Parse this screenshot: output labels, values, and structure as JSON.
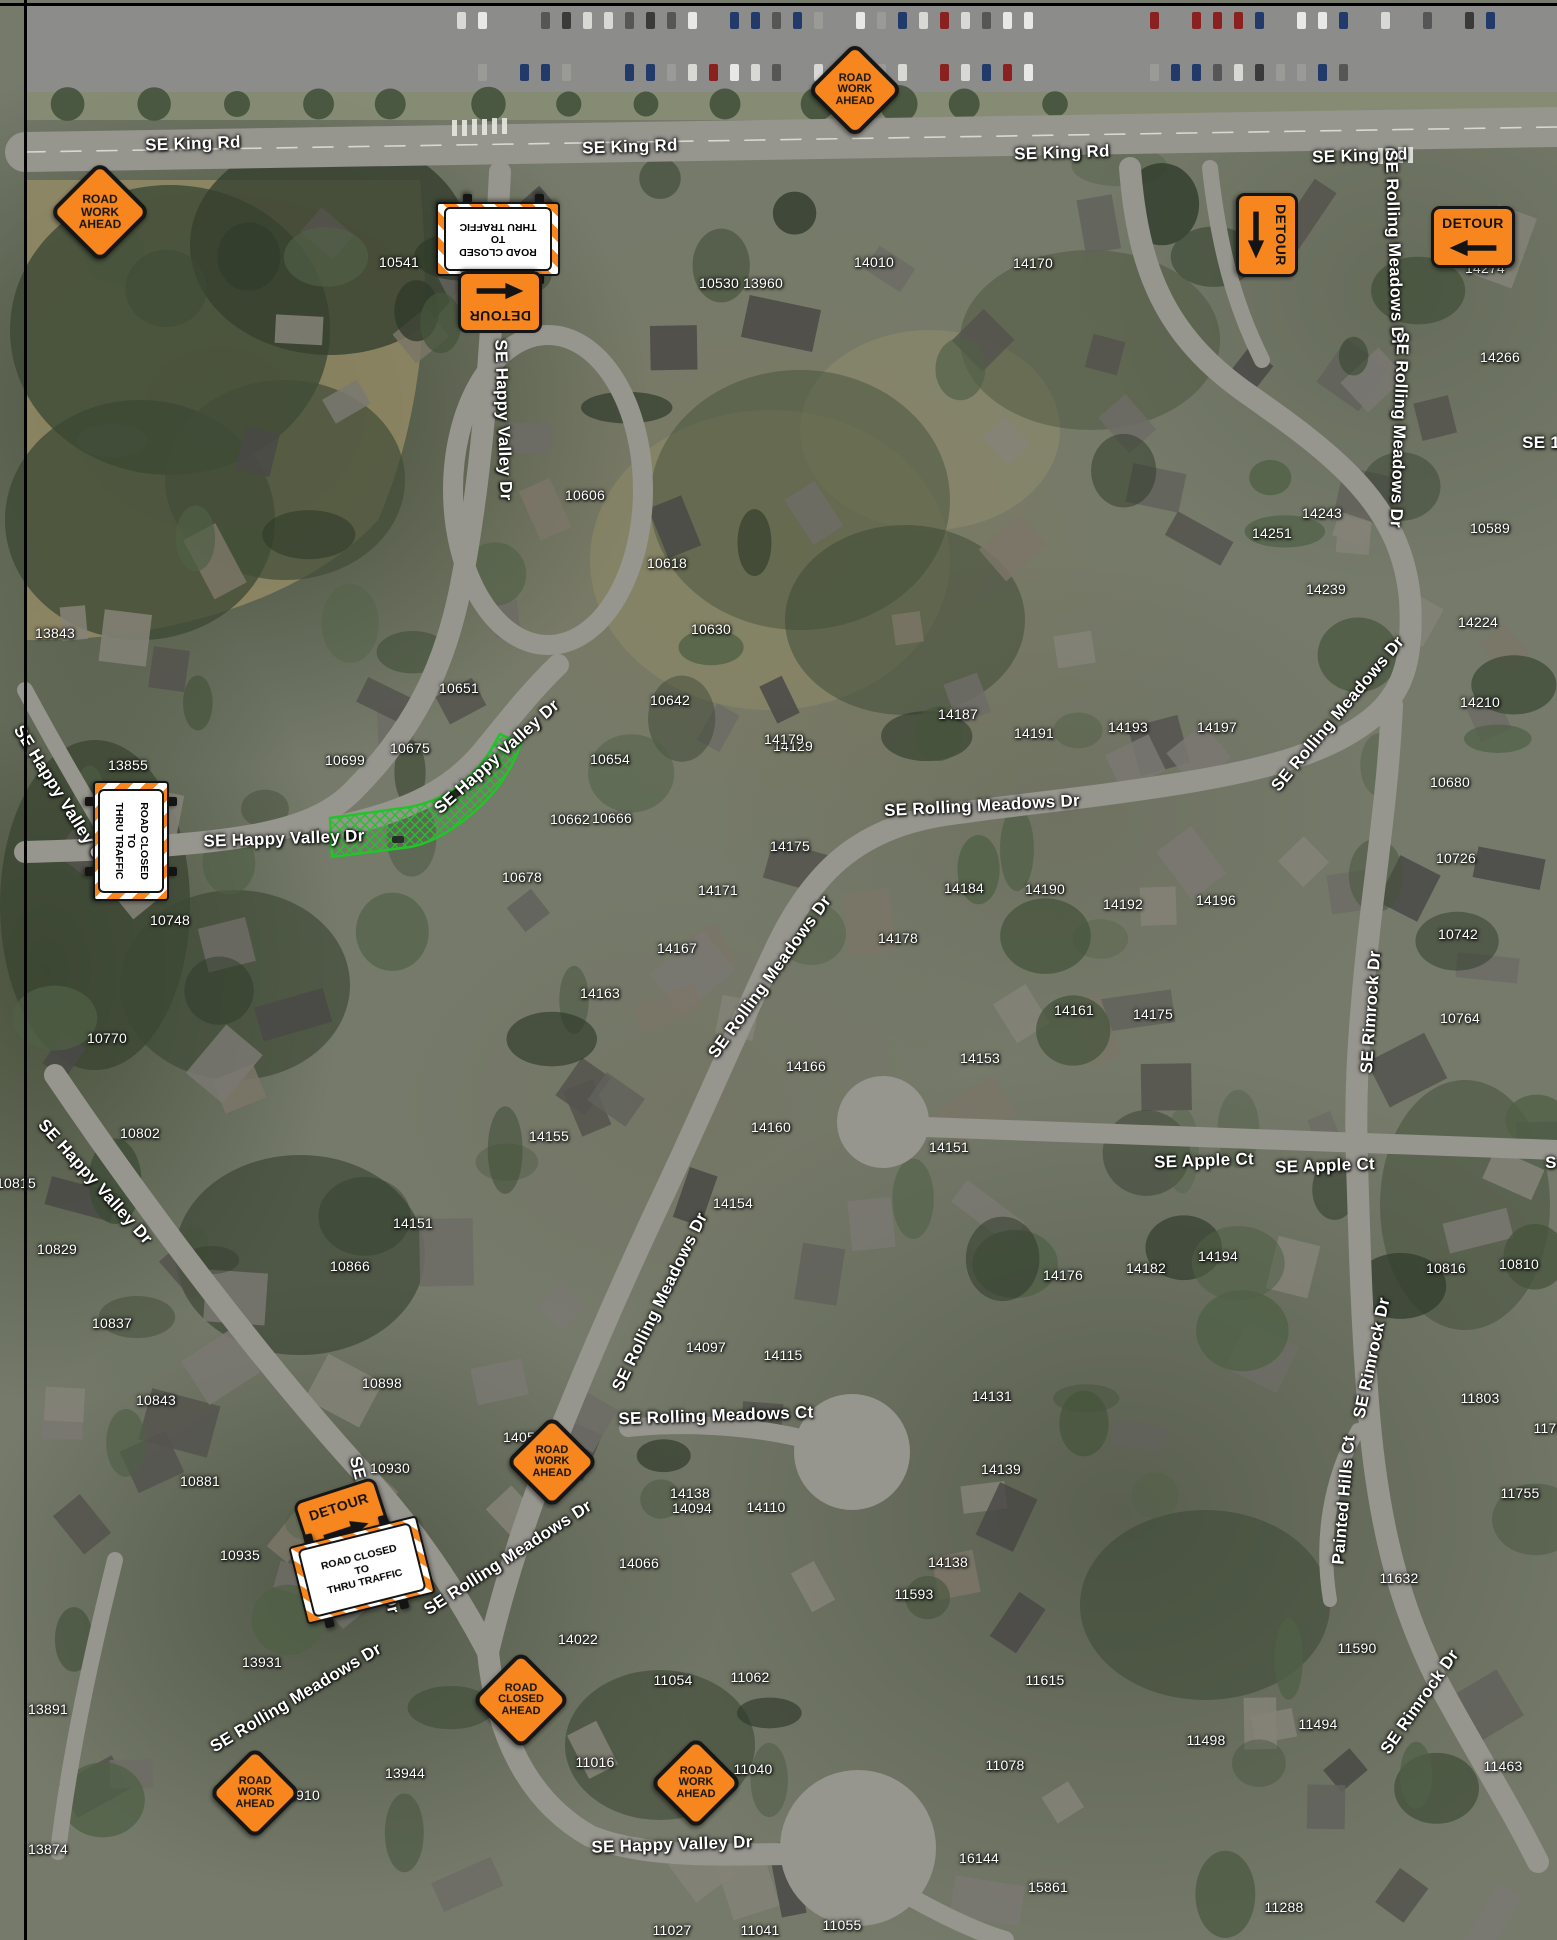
{
  "map": {
    "type": "traffic-control-plan-aerial-map",
    "colors": {
      "sign_orange": "#F6861D",
      "sign_black": "#141414",
      "sign_white": "#FFFFFF",
      "closure_green": "#23C32A",
      "road_gray": "#96958E",
      "label_white": "#FFFFFF"
    },
    "street_labels": [
      {
        "t": "SE King Rd",
        "x": 193,
        "y": 144,
        "r": -2
      },
      {
        "t": "SE King Rd",
        "x": 630,
        "y": 147,
        "r": -2
      },
      {
        "t": "SE King Rd",
        "x": 1062,
        "y": 153,
        "r": -2
      },
      {
        "t": "SE King Rd",
        "x": 1360,
        "y": 156,
        "r": -2
      },
      {
        "t": "SE Happy Valley Dr",
        "x": 503,
        "y": 420,
        "r": 88
      },
      {
        "t": "SE Happy Valley Dr",
        "x": 497,
        "y": 757,
        "r": -42
      },
      {
        "t": "SE Happy Valley Dr",
        "x": 284,
        "y": 839,
        "r": -2
      },
      {
        "t": "SE Happy Valley Ct",
        "x": 60,
        "y": 795,
        "r": 58
      },
      {
        "t": "SE Happy Valley Dr",
        "x": 95,
        "y": 1182,
        "r": 48
      },
      {
        "t": "SE Rolling Meadows Dr",
        "x": 1394,
        "y": 248,
        "r": 88
      },
      {
        "t": "SE Rolling Meadows Dr",
        "x": 1399,
        "y": 430,
        "r": 92
      },
      {
        "t": "SE Rolling Meadows Dr",
        "x": 1338,
        "y": 714,
        "r": -50
      },
      {
        "t": "SE Rolling Meadows Dr",
        "x": 982,
        "y": 806,
        "r": -3
      },
      {
        "t": "SE Rolling Meadows Dr",
        "x": 770,
        "y": 977,
        "r": -54
      },
      {
        "t": "SE Rolling Meadows Dr",
        "x": 660,
        "y": 1302,
        "r": -64
      },
      {
        "t": "SE Rimrock Dr",
        "x": 1371,
        "y": 1012,
        "r": -86
      },
      {
        "t": "SE Rimrock Dr",
        "x": 1372,
        "y": 1358,
        "r": -78
      },
      {
        "t": "SE Rimrock Dr",
        "x": 1420,
        "y": 1702,
        "r": -55
      },
      {
        "t": "SE Apple Ct",
        "x": 1204,
        "y": 1161,
        "r": -2
      },
      {
        "t": "SE Apple Ct",
        "x": 1325,
        "y": 1166,
        "r": -2
      },
      {
        "t": "S",
        "x": 1551,
        "y": 1163,
        "r": 0
      },
      {
        "t": "SE Rolling Meadows Ct",
        "x": 716,
        "y": 1416,
        "r": -2
      },
      {
        "t": "SE Rolling Meadows Dr",
        "x": 508,
        "y": 1558,
        "r": -33
      },
      {
        "t": "SE Rolling Meadows Dr",
        "x": 296,
        "y": 1698,
        "r": -31
      },
      {
        "t": "SE Happy Valley Dr",
        "x": 672,
        "y": 1845,
        "r": -2
      },
      {
        "t": "Painted Hills Ct",
        "x": 1344,
        "y": 1500,
        "r": -85
      },
      {
        "t": "SE Happy Valley Dr",
        "x": 374,
        "y": 1535,
        "r": 76
      },
      {
        "t": "SE 14",
        "x": 1546,
        "y": 443,
        "r": 0
      }
    ],
    "house_numbers": [
      {
        "t": "10541",
        "x": 399,
        "y": 262
      },
      {
        "t": "10530 13960",
        "x": 741,
        "y": 283
      },
      {
        "t": "14010",
        "x": 874,
        "y": 262
      },
      {
        "t": "14170",
        "x": 1033,
        "y": 263
      },
      {
        "t": "14274",
        "x": 1485,
        "y": 268
      },
      {
        "t": "14266",
        "x": 1500,
        "y": 357
      },
      {
        "t": "10589",
        "x": 1490,
        "y": 528
      },
      {
        "t": "14243",
        "x": 1322,
        "y": 513
      },
      {
        "t": "14251",
        "x": 1272,
        "y": 533
      },
      {
        "t": "14239",
        "x": 1326,
        "y": 589
      },
      {
        "t": "14224",
        "x": 1478,
        "y": 622
      },
      {
        "t": "14210",
        "x": 1480,
        "y": 702
      },
      {
        "t": "10680",
        "x": 1450,
        "y": 782
      },
      {
        "t": "10726",
        "x": 1456,
        "y": 858
      },
      {
        "t": "10742",
        "x": 1458,
        "y": 934
      },
      {
        "t": "10764",
        "x": 1460,
        "y": 1018
      },
      {
        "t": "13843",
        "x": 55,
        "y": 633
      },
      {
        "t": "13855",
        "x": 128,
        "y": 765
      },
      {
        "t": "10606",
        "x": 585,
        "y": 495
      },
      {
        "t": "10618",
        "x": 667,
        "y": 563
      },
      {
        "t": "10630",
        "x": 711,
        "y": 629
      },
      {
        "t": "10651",
        "x": 459,
        "y": 688
      },
      {
        "t": "10675",
        "x": 410,
        "y": 748
      },
      {
        "t": "10699",
        "x": 345,
        "y": 760
      },
      {
        "t": "10642",
        "x": 670,
        "y": 700
      },
      {
        "t": "10654",
        "x": 610,
        "y": 759
      },
      {
        "t": "14129",
        "x": 793,
        "y": 746
      },
      {
        "t": "10662",
        "x": 570,
        "y": 819
      },
      {
        "t": "10666",
        "x": 612,
        "y": 818
      },
      {
        "t": "14187",
        "x": 958,
        "y": 714
      },
      {
        "t": "14191",
        "x": 1034,
        "y": 733
      },
      {
        "t": "14193",
        "x": 1128,
        "y": 727
      },
      {
        "t": "14197",
        "x": 1217,
        "y": 727
      },
      {
        "t": "14179",
        "x": 784,
        "y": 739
      },
      {
        "t": "14175",
        "x": 790,
        "y": 846
      },
      {
        "t": "10678",
        "x": 522,
        "y": 877
      },
      {
        "t": "10748",
        "x": 170,
        "y": 920
      },
      {
        "t": "14171",
        "x": 718,
        "y": 890
      },
      {
        "t": "14184",
        "x": 964,
        "y": 888
      },
      {
        "t": "14190",
        "x": 1045,
        "y": 889
      },
      {
        "t": "14192",
        "x": 1123,
        "y": 904
      },
      {
        "t": "14196",
        "x": 1216,
        "y": 900
      },
      {
        "t": "14167",
        "x": 677,
        "y": 948
      },
      {
        "t": "14178",
        "x": 898,
        "y": 938
      },
      {
        "t": "14163",
        "x": 600,
        "y": 993
      },
      {
        "t": "14161",
        "x": 1074,
        "y": 1010
      },
      {
        "t": "14175",
        "x": 1153,
        "y": 1014
      },
      {
        "t": "14153",
        "x": 980,
        "y": 1058
      },
      {
        "t": "14166",
        "x": 806,
        "y": 1066
      },
      {
        "t": "10770",
        "x": 107,
        "y": 1038
      },
      {
        "t": "10802",
        "x": 140,
        "y": 1133
      },
      {
        "t": "14155",
        "x": 549,
        "y": 1136
      },
      {
        "t": "14160",
        "x": 771,
        "y": 1127
      },
      {
        "t": "14151",
        "x": 949,
        "y": 1147
      },
      {
        "t": "10815",
        "x": 16,
        "y": 1183
      },
      {
        "t": "14151",
        "x": 413,
        "y": 1223
      },
      {
        "t": "14154",
        "x": 733,
        "y": 1203
      },
      {
        "t": "10829",
        "x": 57,
        "y": 1249
      },
      {
        "t": "10866",
        "x": 350,
        "y": 1266
      },
      {
        "t": "14176",
        "x": 1063,
        "y": 1275
      },
      {
        "t": "14182",
        "x": 1146,
        "y": 1268
      },
      {
        "t": "14194",
        "x": 1218,
        "y": 1256
      },
      {
        "t": "10816",
        "x": 1446,
        "y": 1268
      },
      {
        "t": "10810",
        "x": 1519,
        "y": 1264
      },
      {
        "t": "10837",
        "x": 112,
        "y": 1323
      },
      {
        "t": "14097",
        "x": 706,
        "y": 1347
      },
      {
        "t": "14115",
        "x": 783,
        "y": 1355
      },
      {
        "t": "10898",
        "x": 382,
        "y": 1383
      },
      {
        "t": "14131",
        "x": 992,
        "y": 1396
      },
      {
        "t": "11803",
        "x": 1480,
        "y": 1398
      },
      {
        "t": "1170",
        "x": 1549,
        "y": 1428
      },
      {
        "t": "10843",
        "x": 156,
        "y": 1400
      },
      {
        "t": "10930",
        "x": 390,
        "y": 1468
      },
      {
        "t": "14059",
        "x": 523,
        "y": 1437
      },
      {
        "t": "11755",
        "x": 1520,
        "y": 1493
      },
      {
        "t": "14139",
        "x": 1001,
        "y": 1469
      },
      {
        "t": "10881",
        "x": 200,
        "y": 1481
      },
      {
        "t": "14138",
        "x": 690,
        "y": 1493
      },
      {
        "t": "14094",
        "x": 692,
        "y": 1508
      },
      {
        "t": "14110",
        "x": 766,
        "y": 1507
      },
      {
        "t": "14066",
        "x": 639,
        "y": 1563
      },
      {
        "t": "14138",
        "x": 948,
        "y": 1562
      },
      {
        "t": "10935",
        "x": 240,
        "y": 1555
      },
      {
        "t": "11632",
        "x": 1399,
        "y": 1578
      },
      {
        "t": "11593",
        "x": 914,
        "y": 1594
      },
      {
        "t": "14022",
        "x": 578,
        "y": 1639
      },
      {
        "t": "11590",
        "x": 1357,
        "y": 1648
      },
      {
        "t": "13931",
        "x": 262,
        "y": 1662
      },
      {
        "t": "11615",
        "x": 1045,
        "y": 1680
      },
      {
        "t": "11054",
        "x": 673,
        "y": 1680
      },
      {
        "t": "11062",
        "x": 750,
        "y": 1677
      },
      {
        "t": "13891",
        "x": 48,
        "y": 1709
      },
      {
        "t": "11498",
        "x": 1206,
        "y": 1740
      },
      {
        "t": "11494",
        "x": 1318,
        "y": 1724
      },
      {
        "t": "11463",
        "x": 1503,
        "y": 1766
      },
      {
        "t": "13944",
        "x": 405,
        "y": 1773
      },
      {
        "t": "13910",
        "x": 300,
        "y": 1795
      },
      {
        "t": "11016",
        "x": 595,
        "y": 1762
      },
      {
        "t": "11040",
        "x": 753,
        "y": 1769
      },
      {
        "t": "11078",
        "x": 1005,
        "y": 1765
      },
      {
        "t": "13874",
        "x": 48,
        "y": 1849
      },
      {
        "t": "16144",
        "x": 979,
        "y": 1858
      },
      {
        "t": "15861",
        "x": 1048,
        "y": 1887
      },
      {
        "t": "11288",
        "x": 1284,
        "y": 1907
      },
      {
        "t": "11027",
        "x": 672,
        "y": 1930
      },
      {
        "t": "11041",
        "x": 760,
        "y": 1930
      },
      {
        "t": "11055",
        "x": 842,
        "y": 1925
      }
    ],
    "signs": [
      {
        "kind": "diamond",
        "lines": [
          "ROAD",
          "WORK",
          "AHEAD"
        ],
        "x": 100,
        "y": 212,
        "rot": 0,
        "s": 64
      },
      {
        "kind": "diamond",
        "lines": [
          "ROAD",
          "WORK",
          "AHEAD"
        ],
        "x": 855,
        "y": 90,
        "rot": 0,
        "s": 60
      },
      {
        "kind": "barricade",
        "lines": [
          "ROAD CLOSED",
          "TO",
          "THRU TRAFFIC"
        ],
        "x": 498,
        "y": 239,
        "rot": 180,
        "w": 108,
        "h": 60
      },
      {
        "kind": "detour",
        "label": "DETOUR",
        "arrow": "left",
        "x": 500,
        "y": 302,
        "rot": 180,
        "w": 78,
        "h": 56
      },
      {
        "kind": "detour",
        "label": "DETOUR",
        "arrow": "right",
        "x": 1267,
        "y": 235,
        "rot": 90,
        "w": 78,
        "h": 56
      },
      {
        "kind": "detour",
        "label": "DETOUR",
        "arrow": "left",
        "x": 1473,
        "y": 237,
        "rot": 0,
        "w": 78,
        "h": 56
      },
      {
        "kind": "barricade",
        "lines": [
          "ROAD CLOSED",
          "TO",
          "THRU TRAFFIC"
        ],
        "x": 131,
        "y": 841,
        "rot": 90,
        "w": 104,
        "h": 62
      },
      {
        "kind": "detour",
        "label": "DETOUR",
        "arrow": "right",
        "x": 343,
        "y": 1520,
        "rot": -18,
        "w": 80,
        "h": 58
      },
      {
        "kind": "barricade",
        "lines": [
          "ROAD CLOSED",
          "TO",
          "THRU TRAFFIC"
        ],
        "x": 362,
        "y": 1570,
        "rot": -14,
        "w": 116,
        "h": 66
      },
      {
        "kind": "diamond",
        "lines": [
          "ROAD",
          "WORK",
          "AHEAD"
        ],
        "x": 552,
        "y": 1462,
        "rot": 0,
        "s": 58
      },
      {
        "kind": "diamond",
        "lines": [
          "ROAD",
          "CLOSED",
          "AHEAD"
        ],
        "x": 521,
        "y": 1700,
        "rot": 0,
        "s": 62
      },
      {
        "kind": "diamond",
        "lines": [
          "ROAD",
          "WORK",
          "AHEAD"
        ],
        "x": 696,
        "y": 1783,
        "rot": 0,
        "s": 58
      },
      {
        "kind": "diamond",
        "lines": [
          "ROAD",
          "WORK",
          "AHEAD"
        ],
        "x": 255,
        "y": 1793,
        "rot": 0,
        "s": 58
      }
    ],
    "closure": {
      "name": "road-closure-hatched-area",
      "color": "#23C32A"
    }
  }
}
